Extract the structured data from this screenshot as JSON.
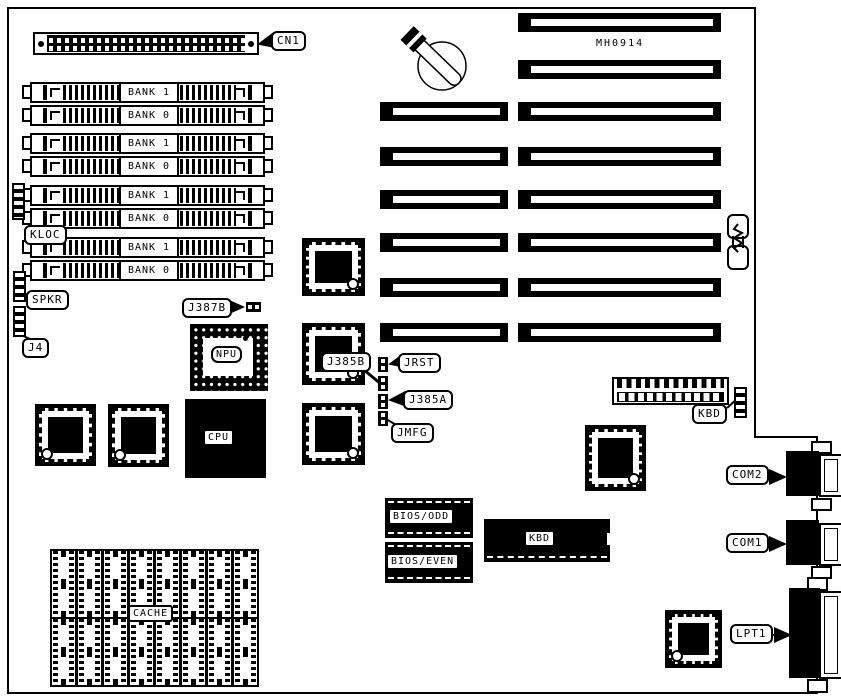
{
  "diagram": {
    "board_id": "MH0914",
    "callouts": {
      "cn1": "CN1",
      "kloc": "KLOC",
      "spkr": "SPKR",
      "j4": "J4",
      "j387b": "J387B",
      "j385b": "J385B",
      "jrst": "JRST",
      "j385a": "J385A",
      "jmfg": "JMFG",
      "kbd": "KBD",
      "com2": "COM2",
      "com1": "COM1",
      "lpt1": "LPT1"
    },
    "chips": {
      "npu": "NPU",
      "cpu": "CPU",
      "kbd": "KBD",
      "bios_odd": "BIOS/ODD",
      "bios_even": "BIOS/EVEN",
      "cache": "CACHE"
    },
    "memory": {
      "banks": [
        "BANK 1",
        "BANK 0",
        "BANK 1",
        "BANK 0",
        "BANK 1",
        "BANK 0",
        "BANK 1",
        "BANK 0"
      ]
    },
    "colors": {
      "ink": "#000000",
      "paper": "#ffffff"
    }
  }
}
